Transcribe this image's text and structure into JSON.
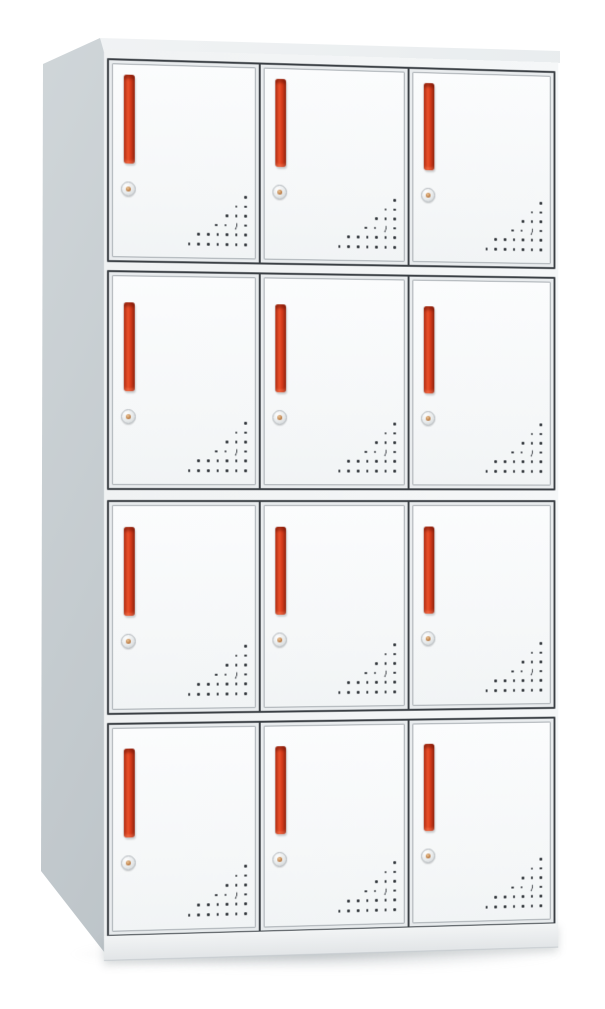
{
  "meta": {
    "alt_text": "Product photo of a white steel locker cabinet with twelve doors, red vertical handles, round key locks and triangular vent hole patterns",
    "background_color": "#ffffff"
  },
  "cabinet": {
    "rows": 4,
    "columns": 3,
    "door_count": 12,
    "colors": {
      "door_face": "#f8fafb",
      "frame_line": "#3a3f44",
      "handle_red": "#d63a1a",
      "handle_red_bright": "#e8502a",
      "handle_red_dark": "#962610",
      "side_panel_light": "#d2d8db",
      "side_panel_dark": "#a9b1b7",
      "top_face": "#eef1f3",
      "base_strip": "#eceff1",
      "lock_body": "#e6e9ea",
      "lock_center": "#b5723a",
      "vent_dot": "#30353a"
    },
    "door_features": {
      "handle": "vertical-red-bar-handle",
      "lock": "round-cam-lock",
      "vents": "triangular-perforation-pattern"
    },
    "vent_pattern": [
      {
        "dots": 1
      },
      {
        "dots": 2
      },
      {
        "dots": 3
      },
      {
        "dots": 4,
        "crescent_from_right": 2
      },
      {
        "dots": 6
      },
      {
        "dots": 7
      }
    ]
  }
}
